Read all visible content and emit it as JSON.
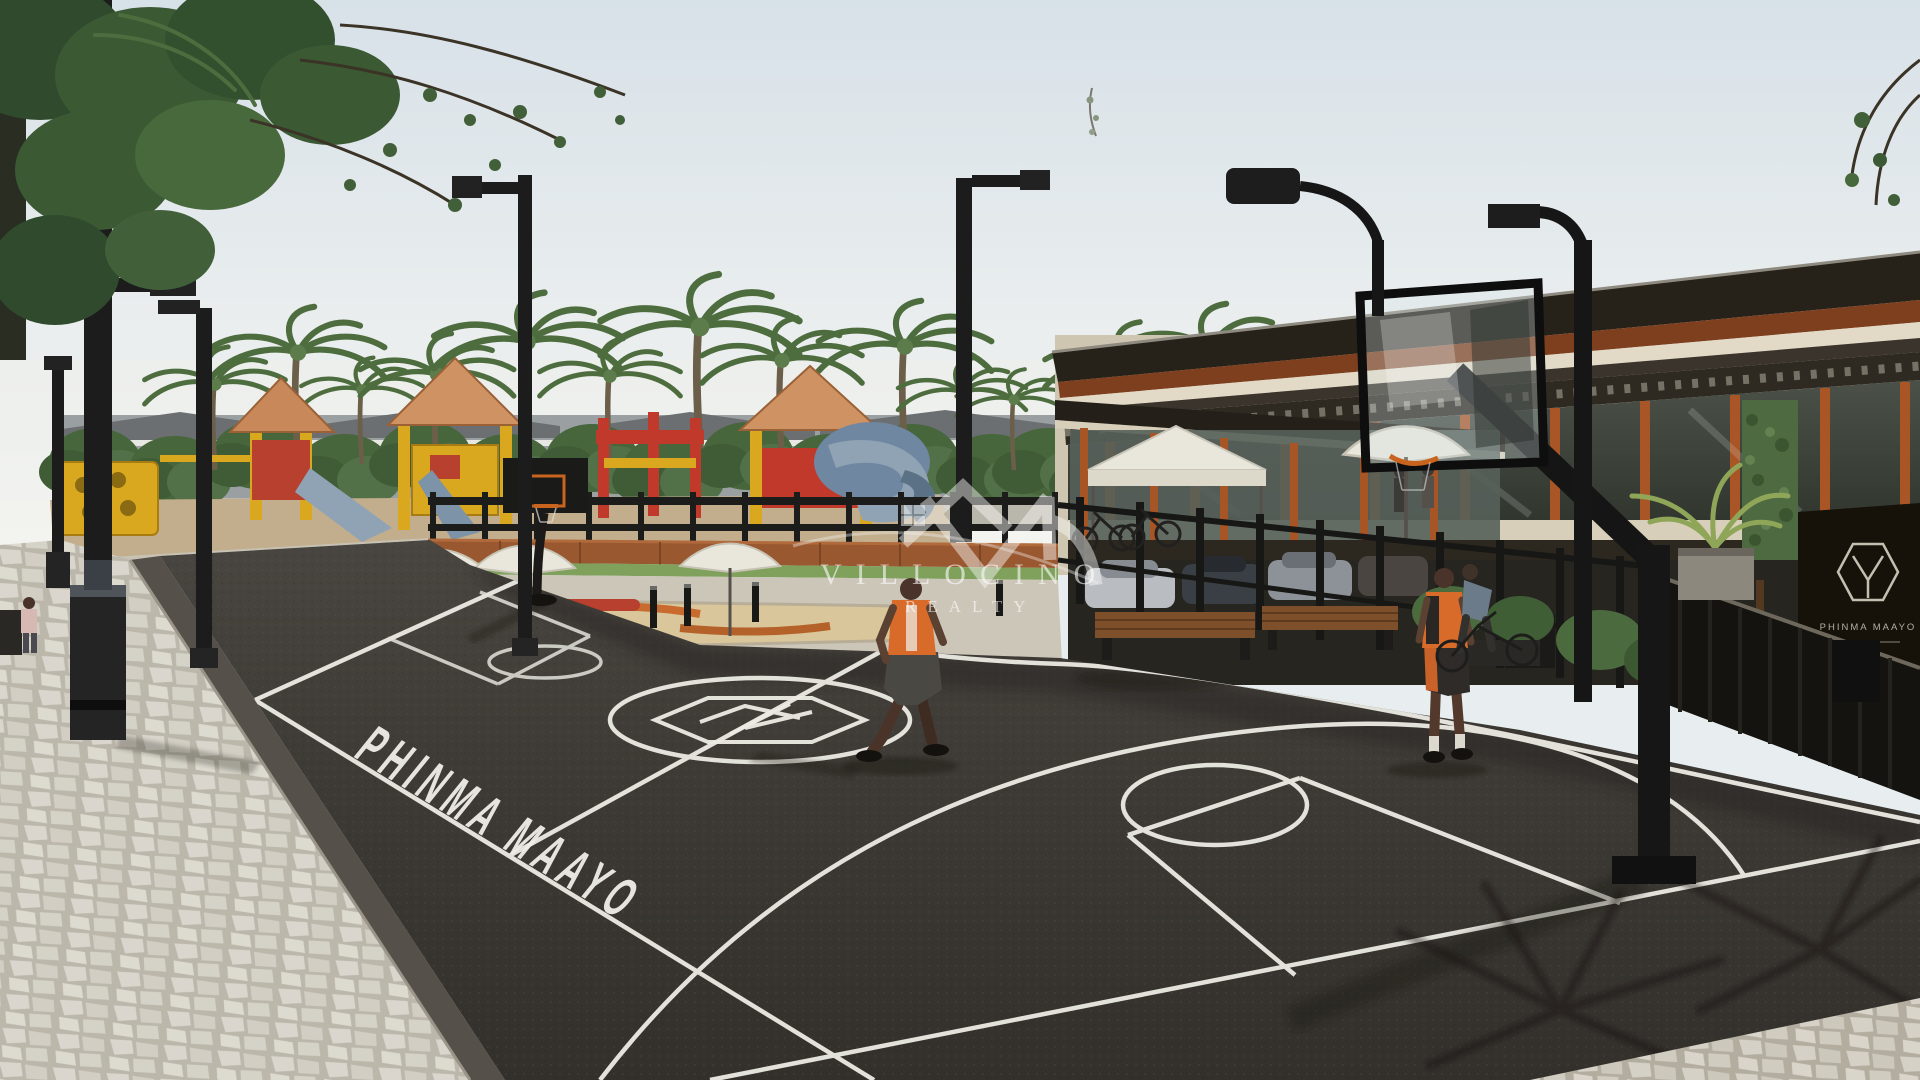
{
  "scene": {
    "watermark": {
      "brand": "VILLOCINO",
      "tagline": "REALTY"
    },
    "court": {
      "paint_text": "PHINMA MAAYO"
    },
    "signage": {
      "building_sign_text": "PHINMA MAAYO"
    },
    "palette": {
      "sky_top": "#d9e2e8",
      "sky_horizon": "#f2f3ef",
      "asphalt_far": "#4b4742",
      "asphalt_near": "#33302c",
      "court_line": "#ecebe4",
      "cobblestone": "#c9c4b7",
      "foliage": "#47663c",
      "palm_frond": "#4e6d3f",
      "roof_dark": "#262219",
      "terracotta": "#99582f",
      "cream_wall": "#e2dac6",
      "play_yellow": "#d9a81f",
      "play_red": "#b8402f",
      "play_blue": "#7d93a8",
      "jersey_orange": "#d96b2a",
      "watermark_white": "#f5f5f3"
    }
  }
}
